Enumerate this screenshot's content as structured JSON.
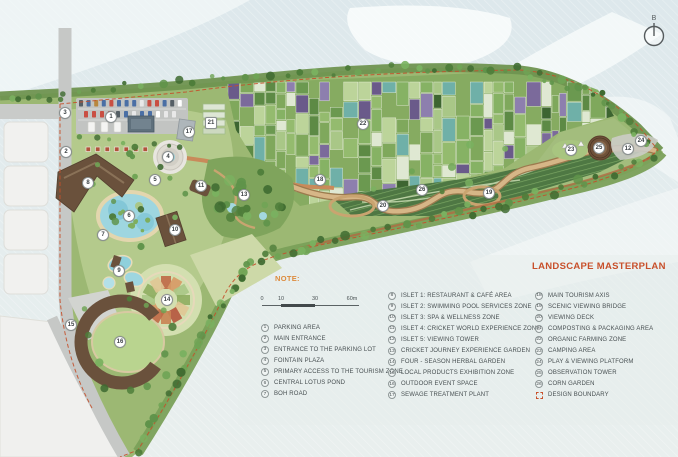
{
  "map": {
    "title": "LANDSCAPE MASTERPLAN",
    "note_label": "NOTE:",
    "compass": {
      "north_label": "B"
    },
    "scale_bar": {
      "ticks": [
        "0",
        "10",
        "30",
        "60m"
      ]
    },
    "colors": {
      "accent": "#C8502B",
      "note": "#DD8B3D",
      "water": "#E3EBED",
      "land": "#9CB873",
      "boundary": "#C4502B"
    },
    "legend": {
      "columns": [
        {
          "items": [
            {
              "num": "1",
              "label": "PARKING AREA"
            },
            {
              "num": "2",
              "label": "MAIN ENTRANCE"
            },
            {
              "num": "3",
              "label": "ENTRANCE TO THE PARKING LOT"
            },
            {
              "num": "4",
              "label": "FOINTAIN PLAZA"
            },
            {
              "num": "5",
              "label": "PRIMARY ACCESS TO THE TOURISM ZONE"
            },
            {
              "num": "6",
              "label": "CENTRAL LOTUS POND"
            },
            {
              "num": "7",
              "label": "BOH ROAD"
            }
          ]
        },
        {
          "items": [
            {
              "num": "8",
              "label": "ISLET 1: RESTAURANT & CAFÉ AREA"
            },
            {
              "num": "9",
              "label": "ISLET 2: SWIMMING POOL SERVICES ZONE"
            },
            {
              "num": "10",
              "label": "ISLET 3: SPA & WELLNESS ZONE"
            },
            {
              "num": "11",
              "label": "ISLET 4: CRICKET WORLD EXPERIENCE ZONE"
            },
            {
              "num": "12",
              "label": "ISLET 5: VIEWING TOWER"
            },
            {
              "num": "13",
              "label": "CRICKET JOURNEY EXPERIENCE GARDEN"
            },
            {
              "num": "14",
              "label": "FOUR - SEASON HERBAL GARDEN"
            },
            {
              "num": "15",
              "label": "LOCAL PRODUCTS EXHIBITION ZONE"
            },
            {
              "num": "16",
              "label": "OUTDOOR EVENT SPACE"
            },
            {
              "num": "17",
              "label": "SEWAGE TREATMENT PLANT"
            }
          ]
        },
        {
          "items": [
            {
              "num": "18",
              "label": "MAIN TOURISM AXIS"
            },
            {
              "num": "19",
              "label": "SCENIC VIEWING BRIDGE"
            },
            {
              "num": "20",
              "label": "VIEWING DECK"
            },
            {
              "num": "21",
              "label": "COMPOSTING & PACKAGING AREA"
            },
            {
              "num": "22",
              "label": "ORGANIC FARMING ZONE"
            },
            {
              "num": "23",
              "label": "CAMPING AREA"
            },
            {
              "num": "24",
              "label": "PLAY & VIEWING PLATFORM"
            },
            {
              "num": "25",
              "label": "OBSERVATION TOWER"
            },
            {
              "num": "26",
              "label": "CORN GARDEN"
            },
            {
              "swatch": "dashed-box",
              "label": "DESIGN BOUNDARY"
            }
          ]
        }
      ]
    },
    "markers": [
      {
        "num": "1",
        "x": 111,
        "y": 117
      },
      {
        "num": "2",
        "x": 66,
        "y": 152
      },
      {
        "num": "3",
        "x": 65,
        "y": 113
      },
      {
        "num": "4",
        "x": 168,
        "y": 157
      },
      {
        "num": "5",
        "x": 155,
        "y": 180
      },
      {
        "num": "6",
        "x": 129,
        "y": 216
      },
      {
        "num": "7",
        "x": 103,
        "y": 235
      },
      {
        "num": "8",
        "x": 88,
        "y": 183
      },
      {
        "num": "9",
        "x": 119,
        "y": 271
      },
      {
        "num": "10",
        "x": 175,
        "y": 230
      },
      {
        "num": "11",
        "x": 201,
        "y": 186
      },
      {
        "num": "12",
        "x": 628,
        "y": 149
      },
      {
        "num": "13",
        "x": 244,
        "y": 195
      },
      {
        "num": "14",
        "x": 167,
        "y": 300
      },
      {
        "num": "15",
        "x": 71,
        "y": 325
      },
      {
        "num": "16",
        "x": 120,
        "y": 342
      },
      {
        "num": "17",
        "x": 189,
        "y": 132
      },
      {
        "num": "18",
        "x": 320,
        "y": 180
      },
      {
        "num": "19",
        "x": 489,
        "y": 193
      },
      {
        "num": "20",
        "x": 383,
        "y": 206
      },
      {
        "num": "21",
        "x": 211,
        "y": 123,
        "shape": "square"
      },
      {
        "num": "22",
        "x": 363,
        "y": 124
      },
      {
        "num": "23",
        "x": 571,
        "y": 150
      },
      {
        "num": "24",
        "x": 641,
        "y": 141
      },
      {
        "num": "25",
        "x": 599,
        "y": 148
      },
      {
        "num": "26",
        "x": 422,
        "y": 190
      }
    ]
  }
}
